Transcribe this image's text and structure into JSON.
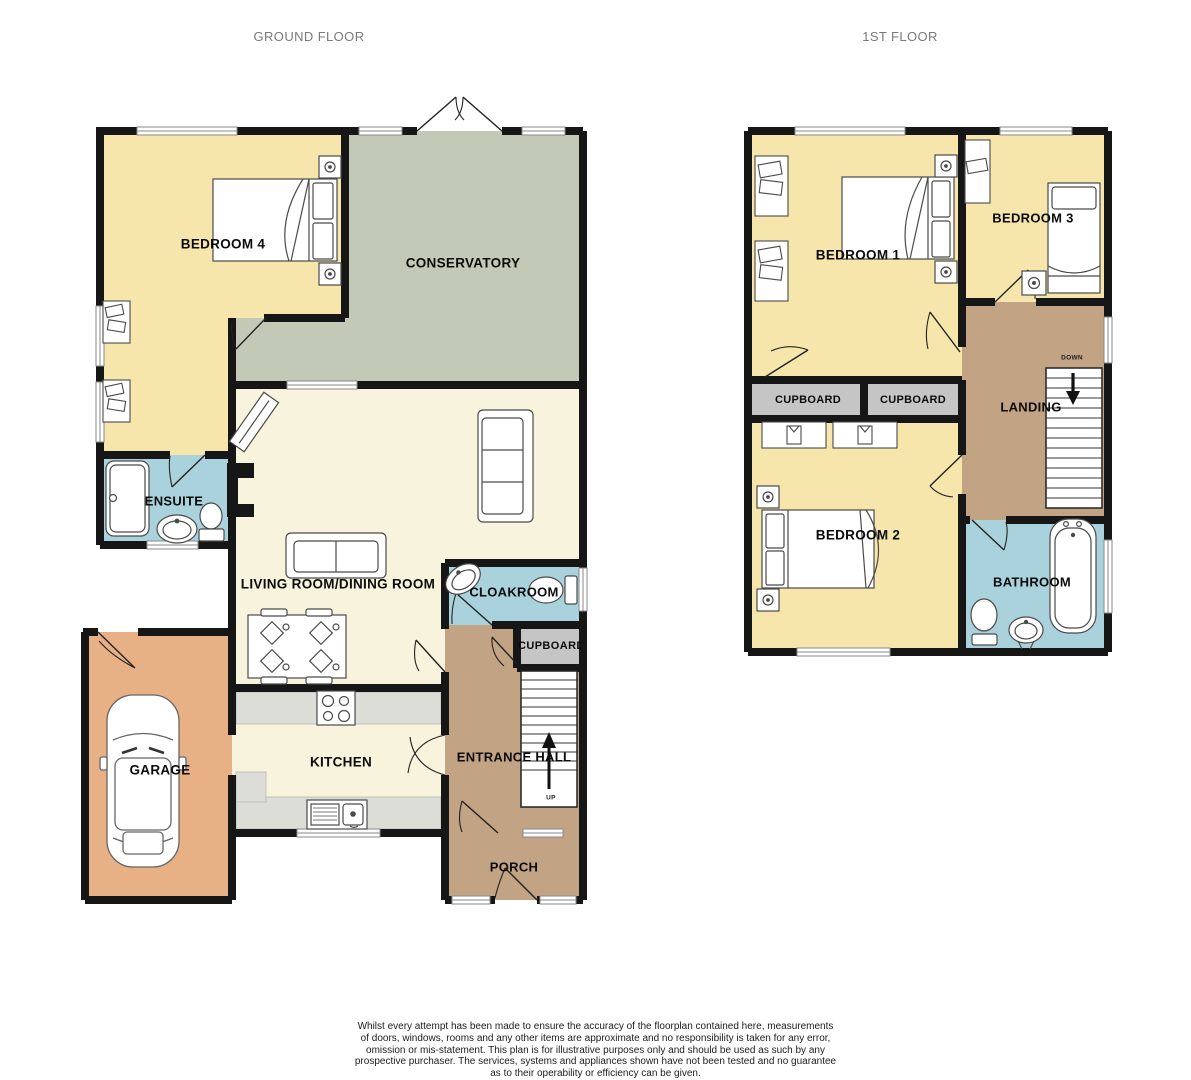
{
  "header": {
    "ground_title": "GROUND FLOOR",
    "first_title": "1ST FLOOR"
  },
  "ground_floor": {
    "rooms": {
      "bedroom4": "BEDROOM 4",
      "conservatory": "CONSERVATORY",
      "ensuite": "ENSUITE",
      "living": "LIVING ROOM/DINING ROOM",
      "cloakroom": "CLOAKROOM",
      "cupboard": "CUPBOARD",
      "garage": "GARAGE",
      "kitchen": "KITCHEN",
      "entrance": "ENTRANCE HALL",
      "porch": "PORCH"
    },
    "stairs_label": "UP"
  },
  "first_floor": {
    "rooms": {
      "bedroom1": "BEDROOM 1",
      "bedroom3": "BEDROOM 3",
      "cupboard_left": "CUPBOARD",
      "cupboard_right": "CUPBOARD",
      "landing": "LANDING",
      "bedroom2": "BEDROOM 2",
      "bathroom": "BATHROOM"
    },
    "stairs_label": "DOWN"
  },
  "footer": {
    "disclaimer_lines": [
      "Whilst every attempt has been made to ensure the accuracy of the floorplan contained here, measurements",
      "of doors, windows, rooms and any other items are approximate and no responsibility is taken for any error,",
      "omission or mis-statement. This plan is for illustrative purposes only and should be used as such by any",
      "prospective purchaser. The services, systems and appliances shown have not been tested and no guarantee",
      "as to their operability or efficiency can be given."
    ],
    "credit": "Made with Metropix ©2025"
  },
  "colors": {
    "bedroom": "#F6E6AC",
    "conservatory": "#C3C9B7",
    "living": "#F8F3DC",
    "wet_room": "#A9D2DC",
    "garage": "#E7B185",
    "hall": "#C2A383",
    "cupboard": "#C5C5C5",
    "counter": "#DDDDD8",
    "wall": "#161616"
  }
}
